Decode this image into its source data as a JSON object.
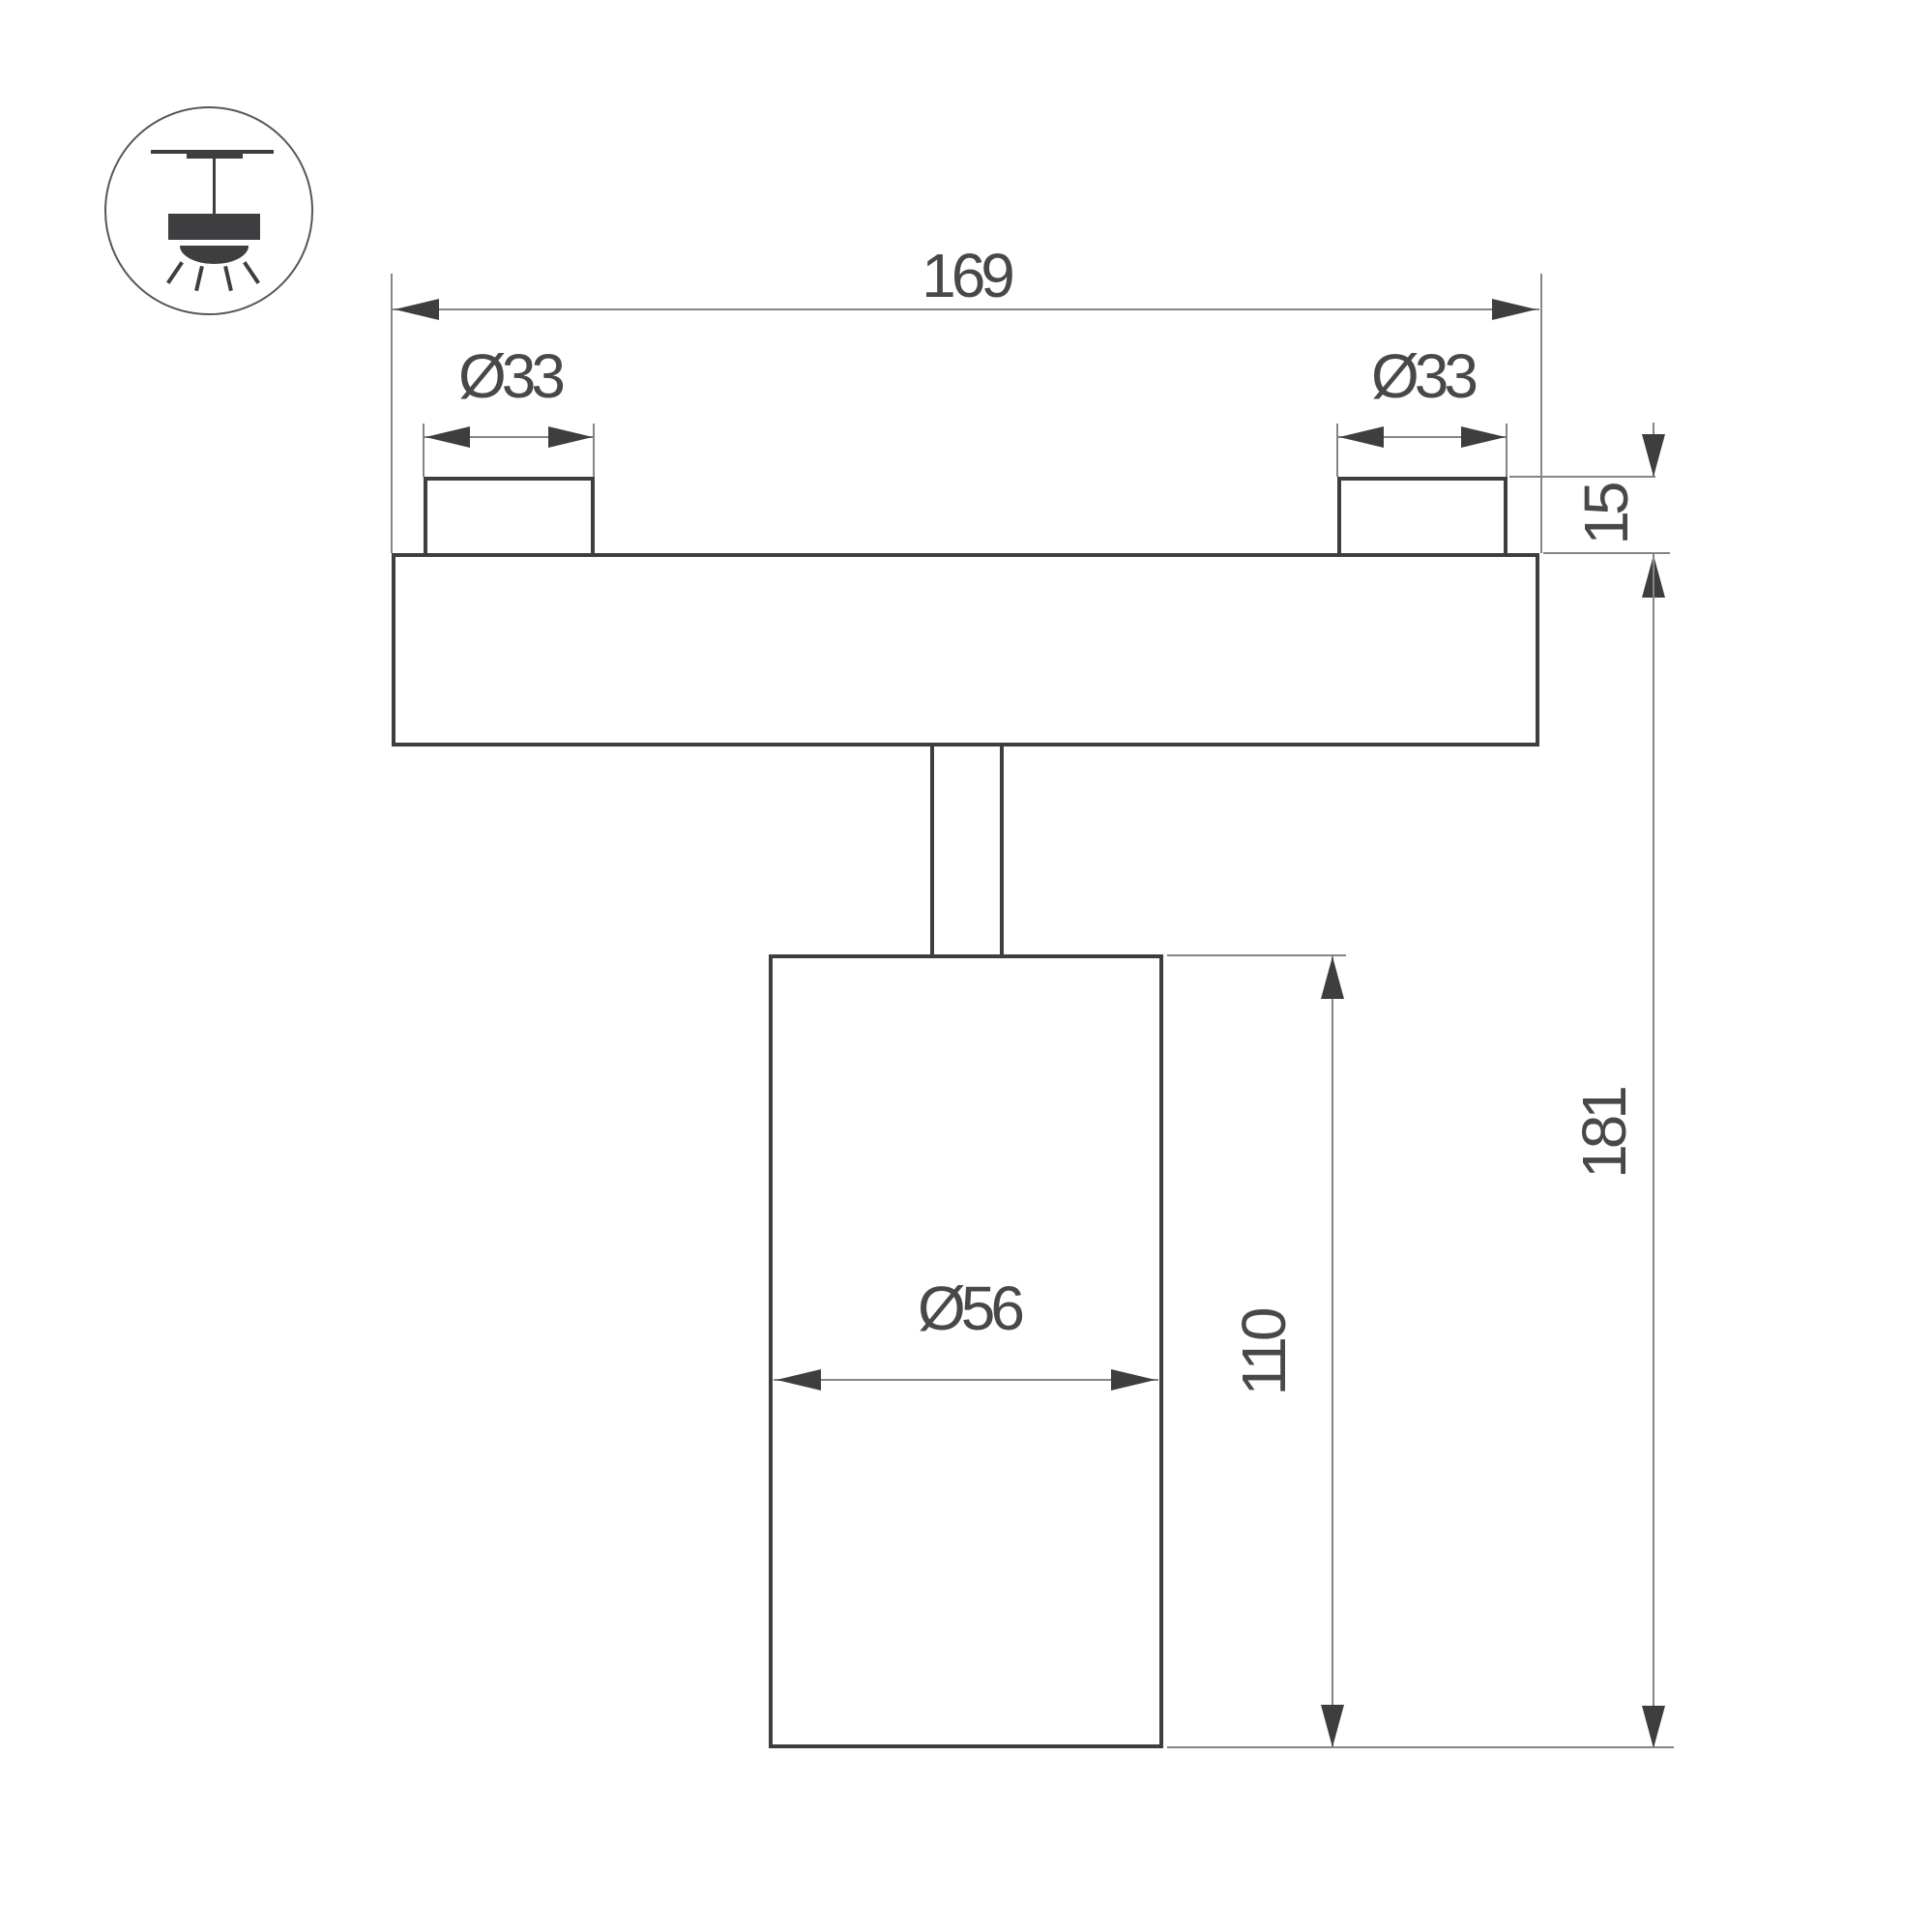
{
  "colors": {
    "background": "#ffffff",
    "outline": "#3e3e40",
    "thin_line": "#858587",
    "text": "#48484a"
  },
  "icon": {
    "type": "ceiling-track-spotlight-symbol"
  },
  "dimensions": {
    "overall_width": "169",
    "left_boss_diameter": "Ø33",
    "right_boss_diameter": "Ø33",
    "base_thickness": "15",
    "body_diameter": "Ø56",
    "body_length": "110",
    "overall_height": "181"
  }
}
